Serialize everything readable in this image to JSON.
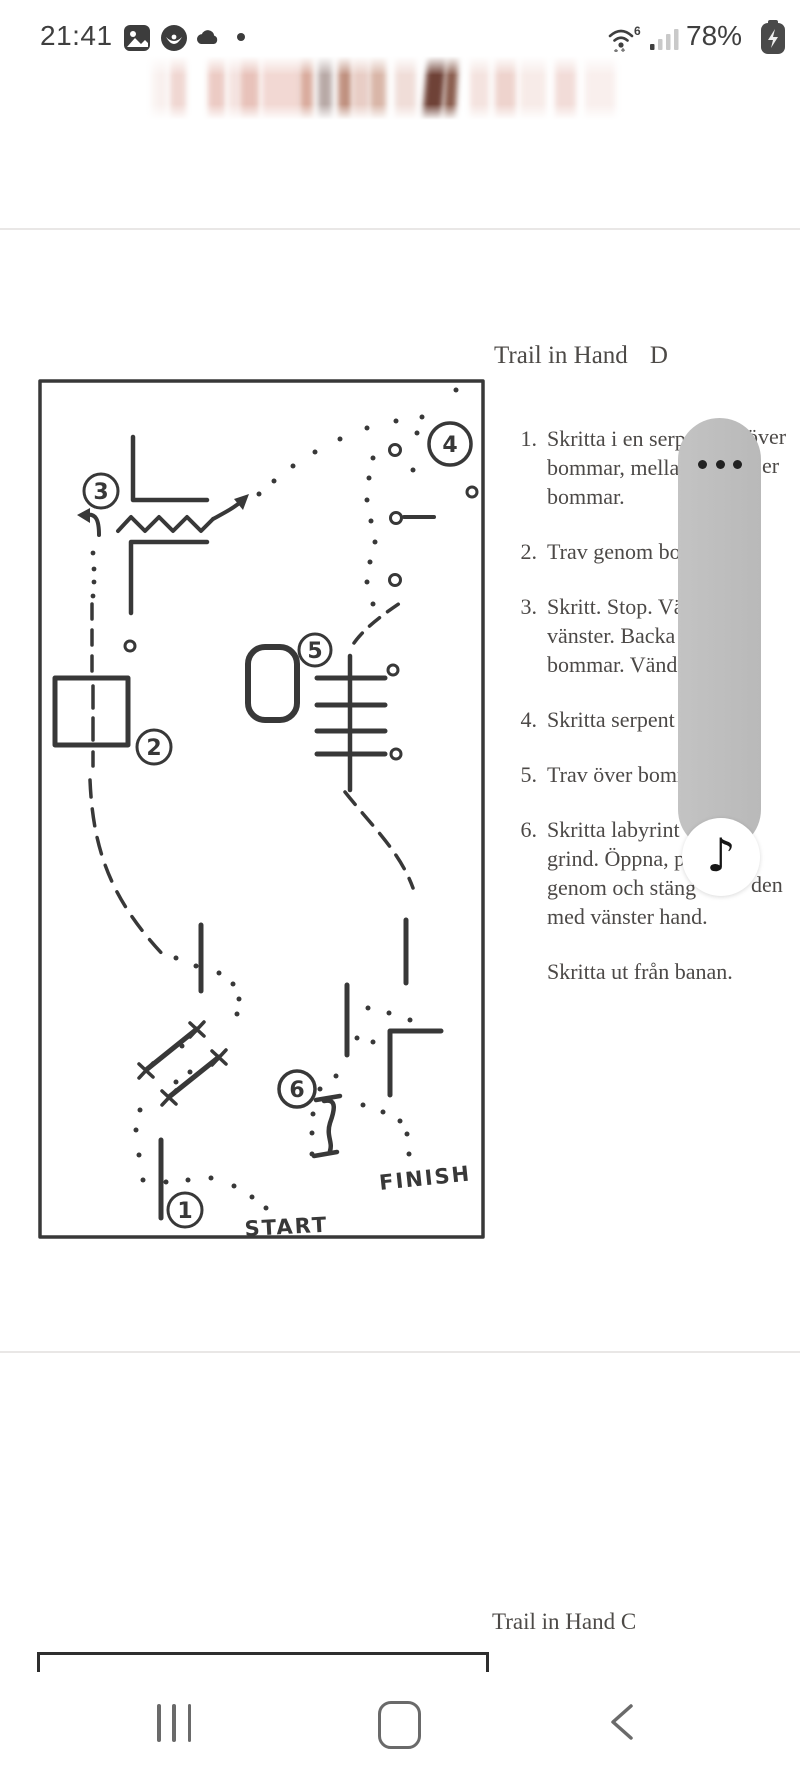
{
  "status_bar": {
    "time": "21:41",
    "wifi_generation": "6",
    "battery_percent": "78%"
  },
  "overlay": {
    "music_icon": "♪"
  },
  "document": {
    "title": "Trail in Hand",
    "title_suffix": "D",
    "items": [
      {
        "num": "1.",
        "lines": [
          "Skritta i en serp",
          "bommar, mella",
          "bommar."
        ]
      },
      {
        "num": "2.",
        "lines": [
          "Trav genom bom"
        ]
      },
      {
        "num": "3.",
        "lines": [
          "Skritt. Stop. Vä",
          "vänster. Backa",
          "bommar. Vänd"
        ]
      },
      {
        "num": "4.",
        "lines": [
          "Skritta serpent"
        ]
      },
      {
        "num": "5.",
        "lines": [
          "Trav över bomm"
        ]
      },
      {
        "num": "6.",
        "lines": [
          "Skritta labyrint",
          "grind. Öppna, p",
          "genom och stäng",
          "med vänster hand."
        ]
      }
    ],
    "fragments": [
      {
        "text": "över"
      },
      {
        "text": "er"
      },
      {
        "text": "den"
      }
    ],
    "outro": "Skritta ut från banan.",
    "map": {
      "n1": "1",
      "n2": "2",
      "n3": "3",
      "n4": "4",
      "n5": "5",
      "n6": "6",
      "start": "START",
      "finish": "FINISH"
    },
    "bottom_title": "Trail in Hand C"
  },
  "colors": {
    "ink": "#383838",
    "scan_text": "#4c4947",
    "overlay_pill": "#bdbdbd",
    "nav_icon": "#6a6a6a",
    "separator": "#e9e7e6"
  }
}
